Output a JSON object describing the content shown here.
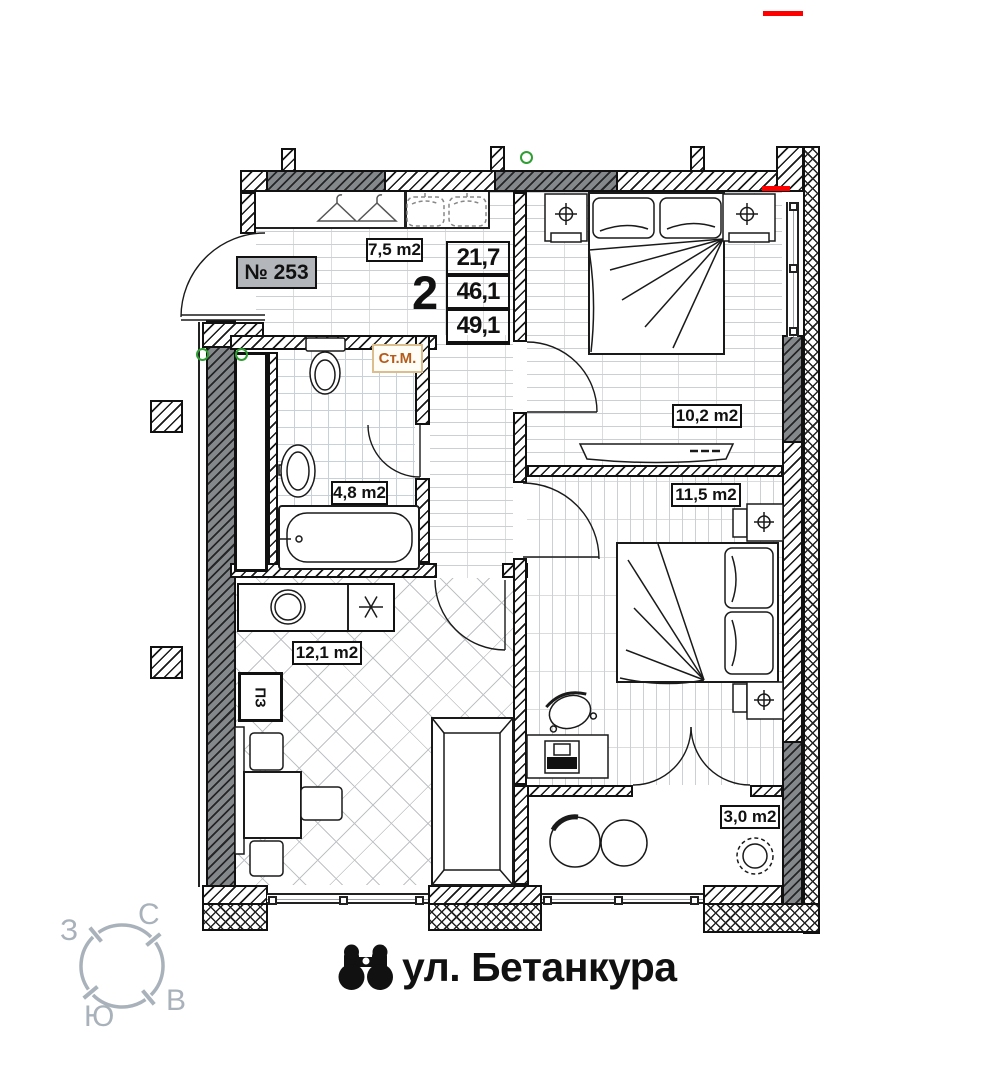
{
  "plan": {
    "apartment_number": "№ 253",
    "rooms_count": "2",
    "area_living": "21,7",
    "area_apartment": "46,1",
    "area_total": "49,1",
    "rooms": {
      "hallway": "7,5 m2",
      "bedroom1": "10,2 m2",
      "bedroom2": "11,5 m2",
      "bathroom": "4,8 m2",
      "kitchen_living": "12,1 m2",
      "balcony": "3,0 m2"
    },
    "labels": {
      "washing_machine": "Ст.М.",
      "fridge": "ПЗ"
    }
  },
  "footer": {
    "street": "ул. Бетанкура"
  },
  "compass": {
    "north": "С",
    "south": "Ю",
    "west": "З",
    "east": "В"
  },
  "colors": {
    "accent_red": "#ff0000",
    "label_orange": "#b55c1c",
    "compass_gray": "#a9b2ba",
    "wall_dark": "#85888b"
  }
}
